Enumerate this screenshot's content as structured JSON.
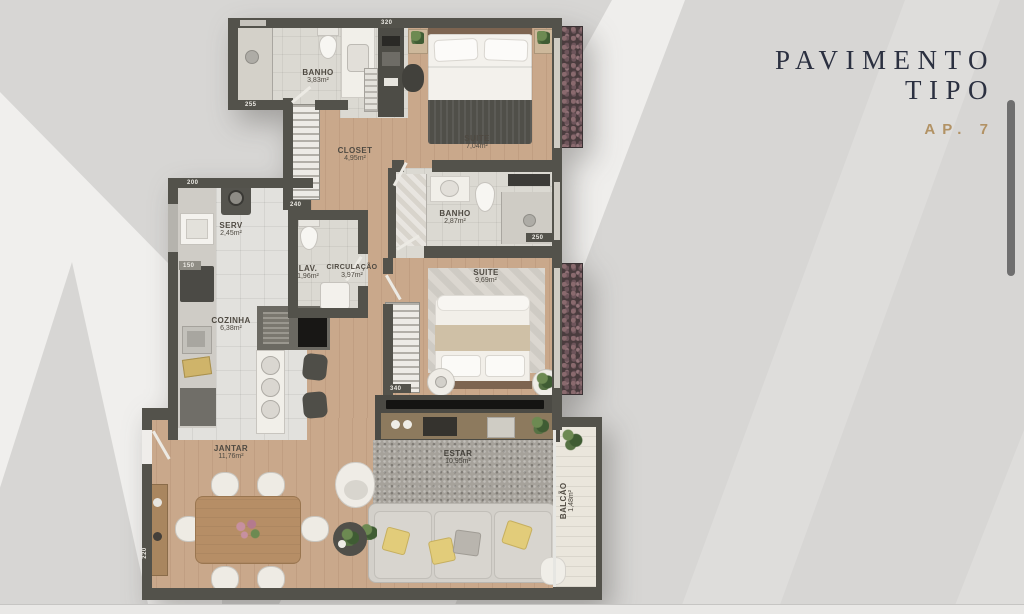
{
  "header": {
    "title_line1": "PAVIMENTO",
    "title_line2": "TIPO",
    "apartment": "AP. 7"
  },
  "rooms": [
    {
      "name": "BANHO",
      "area": "3,83m²"
    },
    {
      "name": "SUITE",
      "area": "7,04m²"
    },
    {
      "name": "CLOSET",
      "area": "4,95m²"
    },
    {
      "name": "SERV",
      "area": "2,45m²"
    },
    {
      "name": "LAV.",
      "area": "1,96m²"
    },
    {
      "name": "CIRCULAÇÃO",
      "area": "3,97m²"
    },
    {
      "name": "BANHO",
      "area": "2,87m²"
    },
    {
      "name": "SUITE",
      "area": "9,69m²"
    },
    {
      "name": "COZINHA",
      "area": "6,38m²"
    },
    {
      "name": "JANTAR",
      "area": "11,76m²"
    },
    {
      "name": "ESTAR",
      "area": "10,95m²"
    },
    {
      "name": "BALCÃO",
      "area": "1,48m²"
    }
  ],
  "dimensions": [
    {
      "value": "255"
    },
    {
      "value": "320"
    },
    {
      "value": "200"
    },
    {
      "value": "150"
    },
    {
      "value": "240"
    },
    {
      "value": "250"
    },
    {
      "value": "340"
    },
    {
      "value": "220"
    }
  ],
  "colors": {
    "wall": "#53524b",
    "wood_floor": "#c9a88b",
    "accent_gold": "#b29264",
    "title_navy": "#2b3040",
    "background": "#d7d6d4"
  }
}
